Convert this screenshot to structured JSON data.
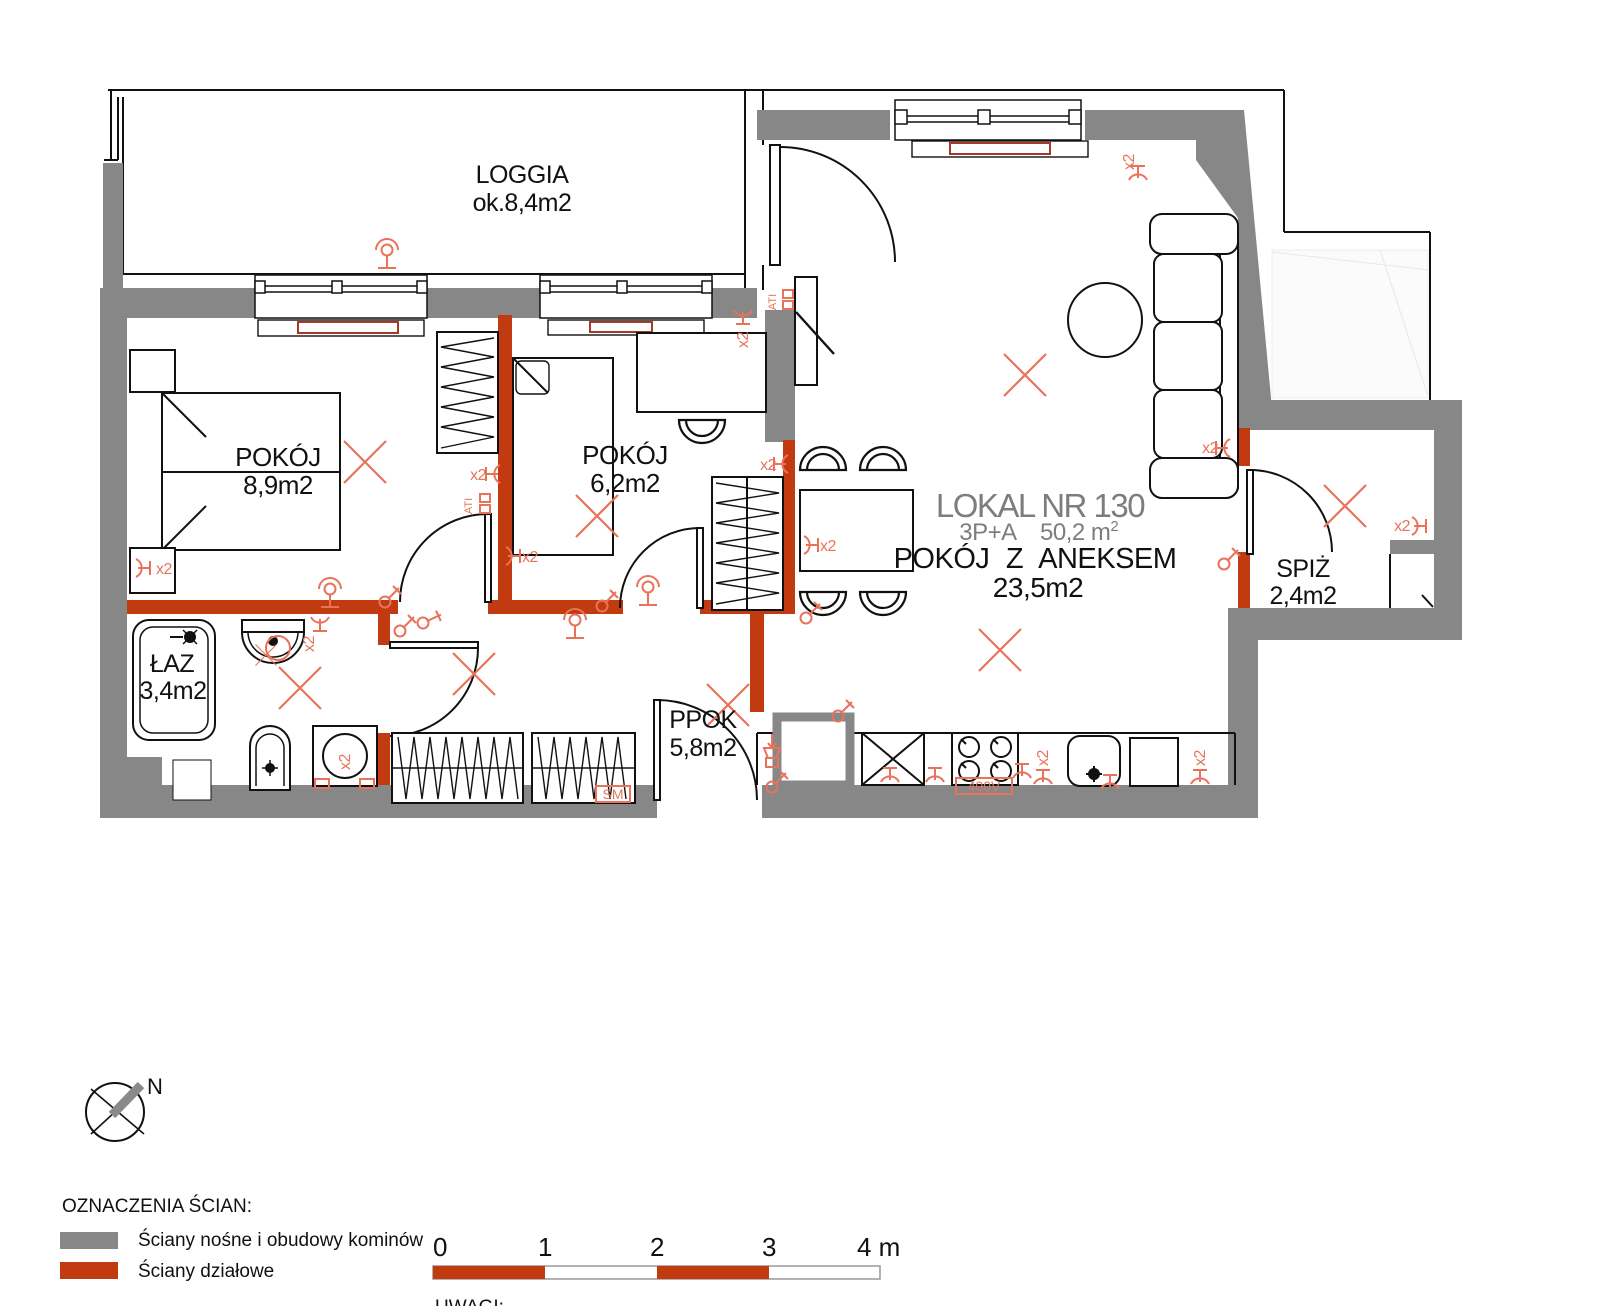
{
  "title_block": {
    "lokal": "LOKAL NR 130",
    "layout_type": "3P+A",
    "total_area": "50,2 m",
    "total_area_sup": "2",
    "annex_room": "POKÓJ Z ANEKSEM",
    "annex_area": "23,5m2"
  },
  "rooms": {
    "loggia": {
      "name": "LOGGIA",
      "area": "ok.8,4m2"
    },
    "bedroom1": {
      "name": "POKÓJ",
      "area": "8,9m2"
    },
    "bedroom2": {
      "name": "POKÓJ",
      "area": "6,2m2"
    },
    "bathroom": {
      "name": "ŁAZ",
      "area": "3,4m2"
    },
    "hall": {
      "name": "PPOK",
      "area": "5,8m2"
    },
    "pantry": {
      "name": "SPIŻ",
      "area": "2,4m2"
    }
  },
  "annotations": {
    "x2": "x2",
    "ati": "ATI",
    "sm": "SM",
    "power": "400V",
    "north": "N",
    "notes_heading": "UWAGI:"
  },
  "legend": {
    "heading": "OZNACZENIA ŚCIAN:",
    "items": [
      {
        "label": "Ściany nośne i obudowy kominów",
        "color": "#878787"
      },
      {
        "label": "Ściany działowe",
        "color": "#c23b10"
      }
    ]
  },
  "scale_bar": {
    "labels": [
      "0",
      "1",
      "2",
      "3"
    ],
    "end_label": "4 m"
  },
  "colors": {
    "load_bearing": "#878787",
    "partition": "#c23b10",
    "symbols": "#e8735a",
    "radiator": "#a63a28"
  }
}
